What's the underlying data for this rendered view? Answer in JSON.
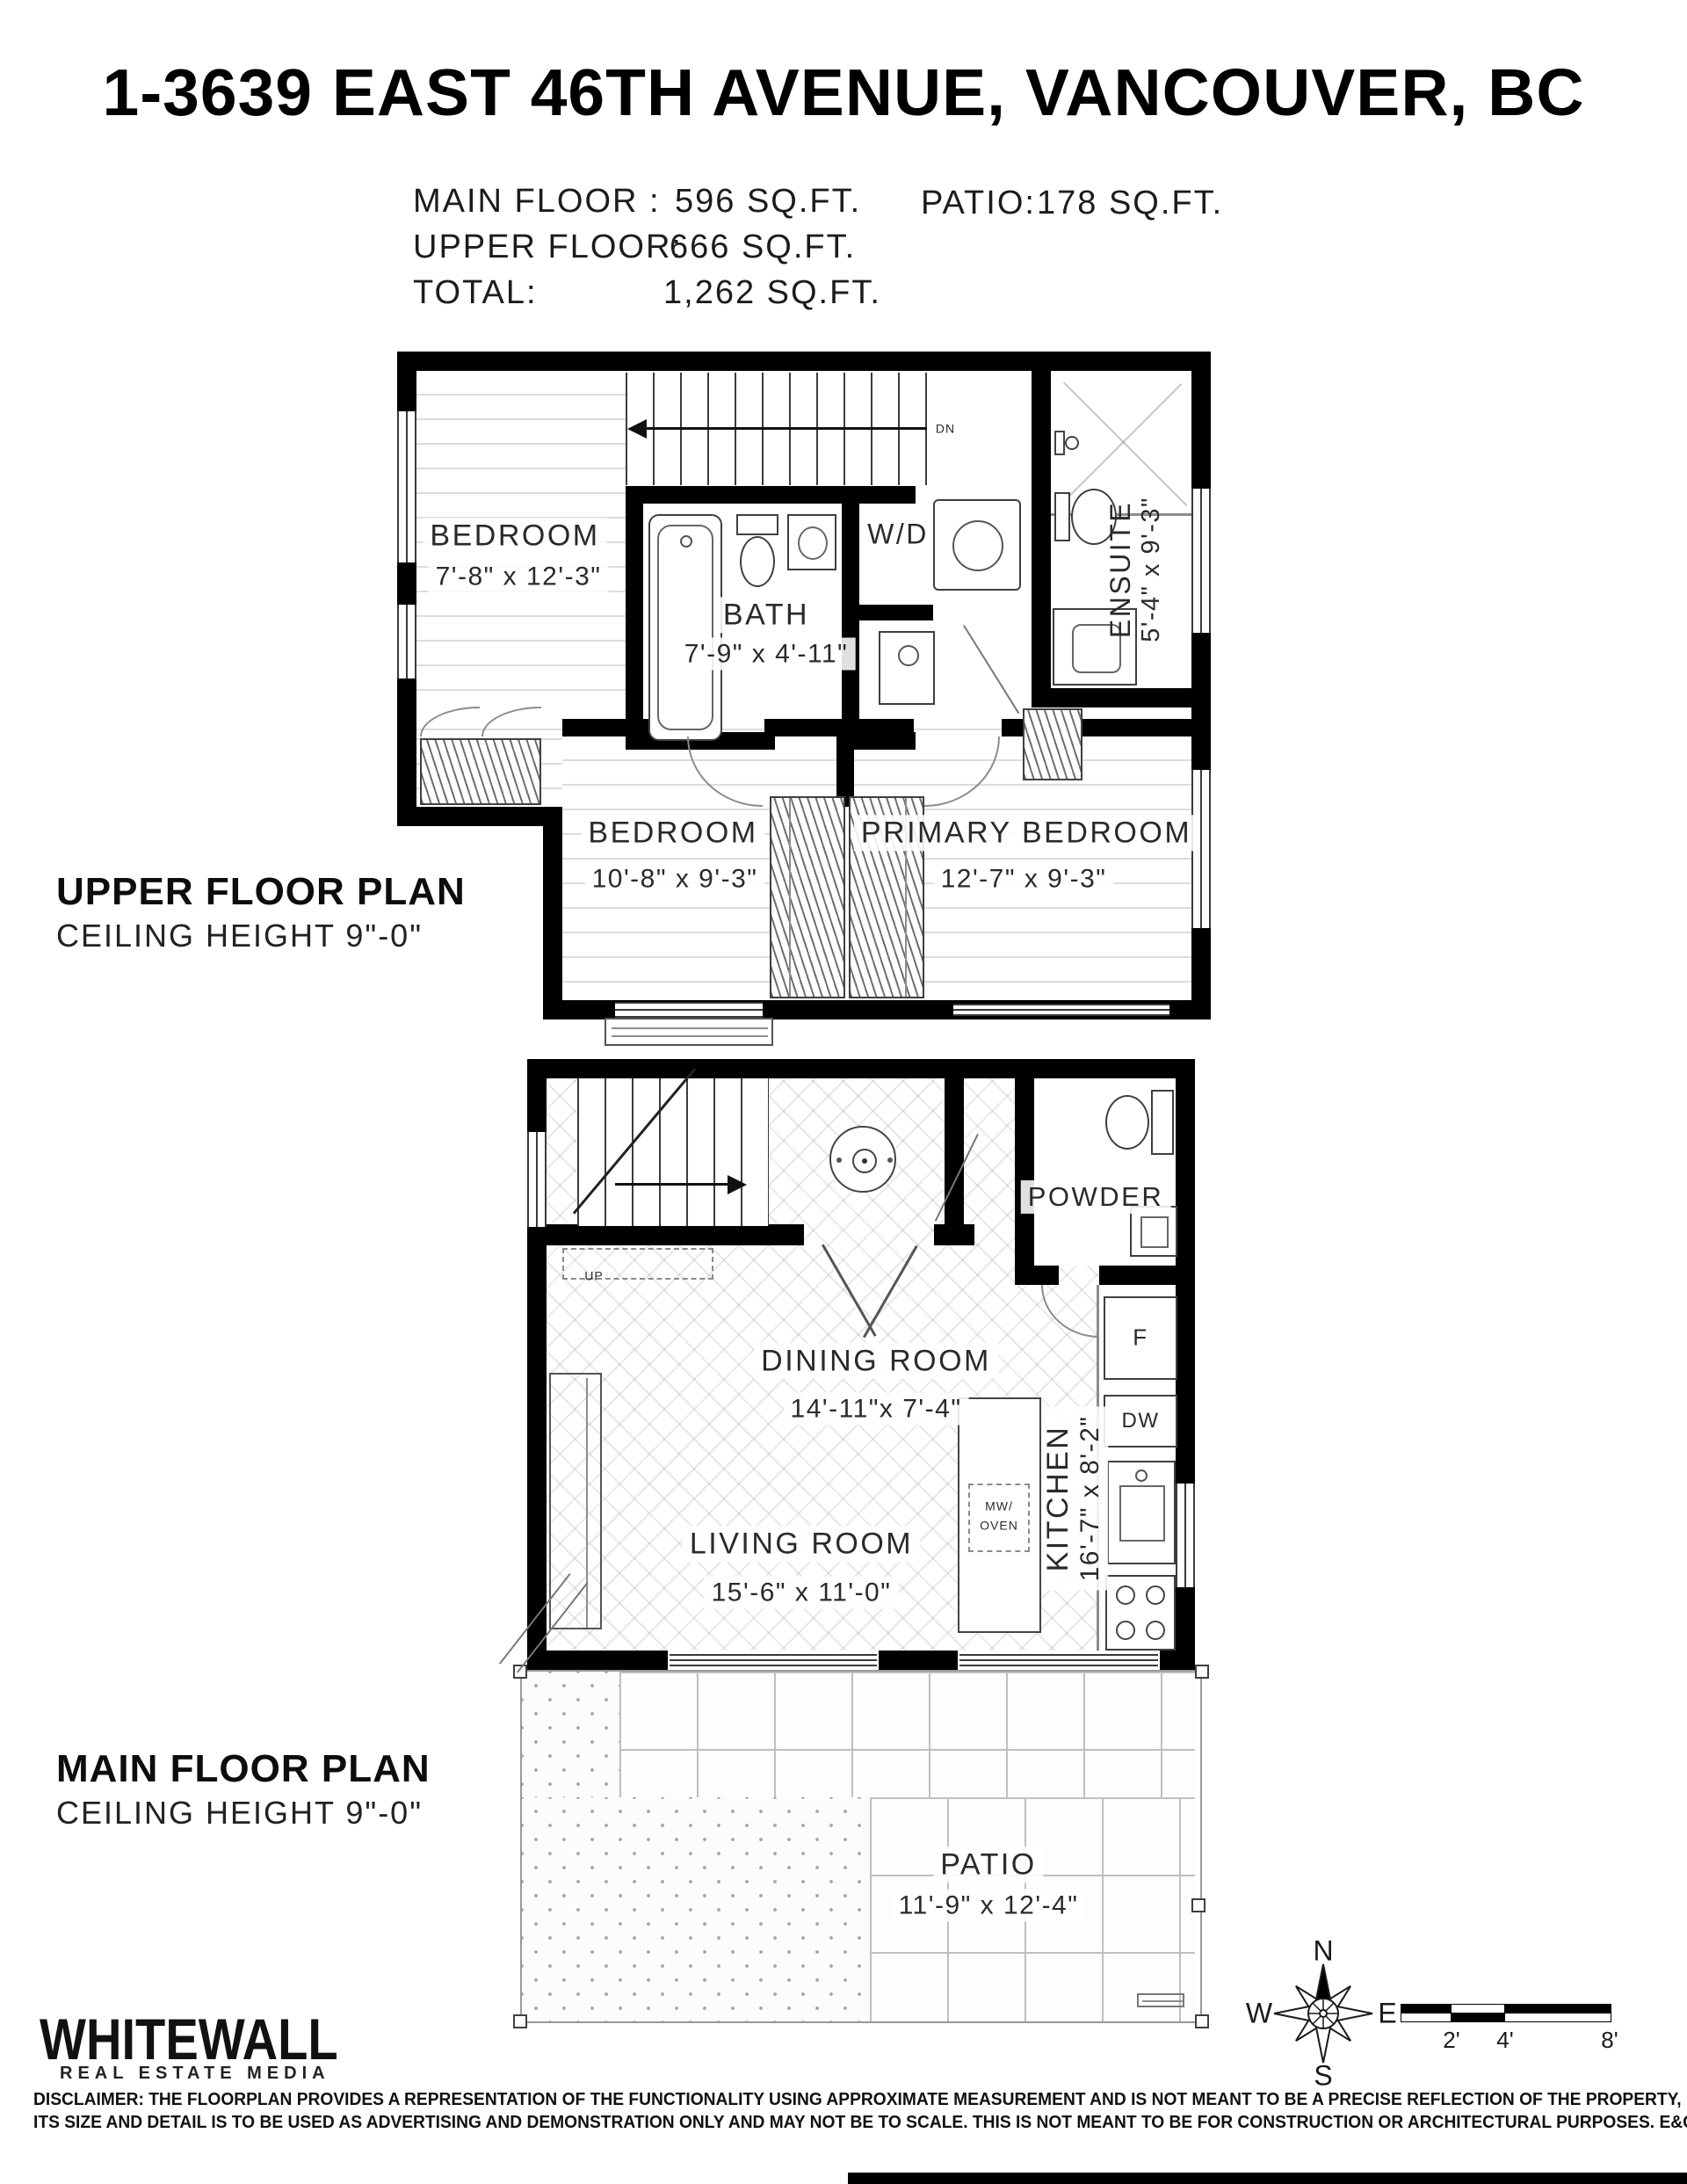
{
  "title": "1-3639 EAST 46TH AVENUE, VANCOUVER, BC",
  "areas": {
    "main_floor_label": "MAIN FLOOR :",
    "main_floor_value": "596 SQ.FT.",
    "upper_floor_label": "UPPER FLOOR:",
    "upper_floor_value": "666 SQ.FT.",
    "total_label": "TOTAL:",
    "total_value": "1,262 SQ.FT.",
    "patio_label": "PATIO:",
    "patio_value": "178 SQ.FT."
  },
  "upper_plan": {
    "heading": "UPPER FLOOR PLAN",
    "subheading": "CEILING HEIGHT 9\"-0\"",
    "stair_label": "DN",
    "rooms": {
      "bedroom1": {
        "name": "BEDROOM",
        "dims": "7'-8\" x 12'-3\""
      },
      "bath": {
        "name": "BATH",
        "dims": "7'-9\" x 4'-11\""
      },
      "wd": {
        "name": "W/D"
      },
      "ensuite": {
        "name": "ENSUITE",
        "dims": "5'-4\" x 9'-3\""
      },
      "bedroom2": {
        "name": "BEDROOM",
        "dims": "10'-8\" x 9'-3\""
      },
      "primary": {
        "name": "PRIMARY BEDROOM",
        "dims": "12'-7\" x 9'-3\""
      }
    }
  },
  "main_plan": {
    "heading": "MAIN FLOOR PLAN",
    "subheading": "CEILING HEIGHT 9\"-0\"",
    "stair_label": "UP",
    "rooms": {
      "dining": {
        "name": "DINING ROOM",
        "dims": "14'-11\"x 7'-4\""
      },
      "living": {
        "name": "LIVING ROOM",
        "dims": "15'-6\" x 11'-0\""
      },
      "kitchen": {
        "name": "KITCHEN",
        "dims": "16'-7\" x 8'-2\""
      },
      "powder": {
        "name": "POWDER"
      },
      "patio": {
        "name": "PATIO",
        "dims": "11'-9\" x 12'-4\""
      }
    },
    "appliances": {
      "fridge": "F",
      "dishwasher": "DW",
      "mw_line1": "MW/",
      "mw_line2": "OVEN"
    }
  },
  "footer": {
    "logo_line1": "WHITEWALL",
    "logo_line2": "REAL ESTATE MEDIA",
    "disclaimer_line1": "DISCLAIMER: THE FLOORPLAN PROVIDES A REPRESENTATION OF THE FUNCTIONALITY USING APPROXIMATE MEASUREMENT AND IS NOT MEANT TO BE A PRECISE REFLECTION OF THE PROPERTY,",
    "disclaimer_line2": "ITS SIZE AND DETAIL IS TO BE USED AS ADVERTISING AND DEMONSTRATION ONLY AND MAY NOT BE TO SCALE. THIS IS NOT MEANT TO BE FOR CONSTRUCTION OR ARCHITECTURAL PURPOSES. E&O INSURED"
  },
  "compass": {
    "n": "N",
    "e": "E",
    "s": "S",
    "w": "W"
  },
  "scale": {
    "l2": "2'",
    "l4": "4'",
    "l8": "8'"
  },
  "colors": {
    "wall": "#000000",
    "thin_line": "#4a4a4a",
    "floor_line": "#dcdcdc"
  }
}
